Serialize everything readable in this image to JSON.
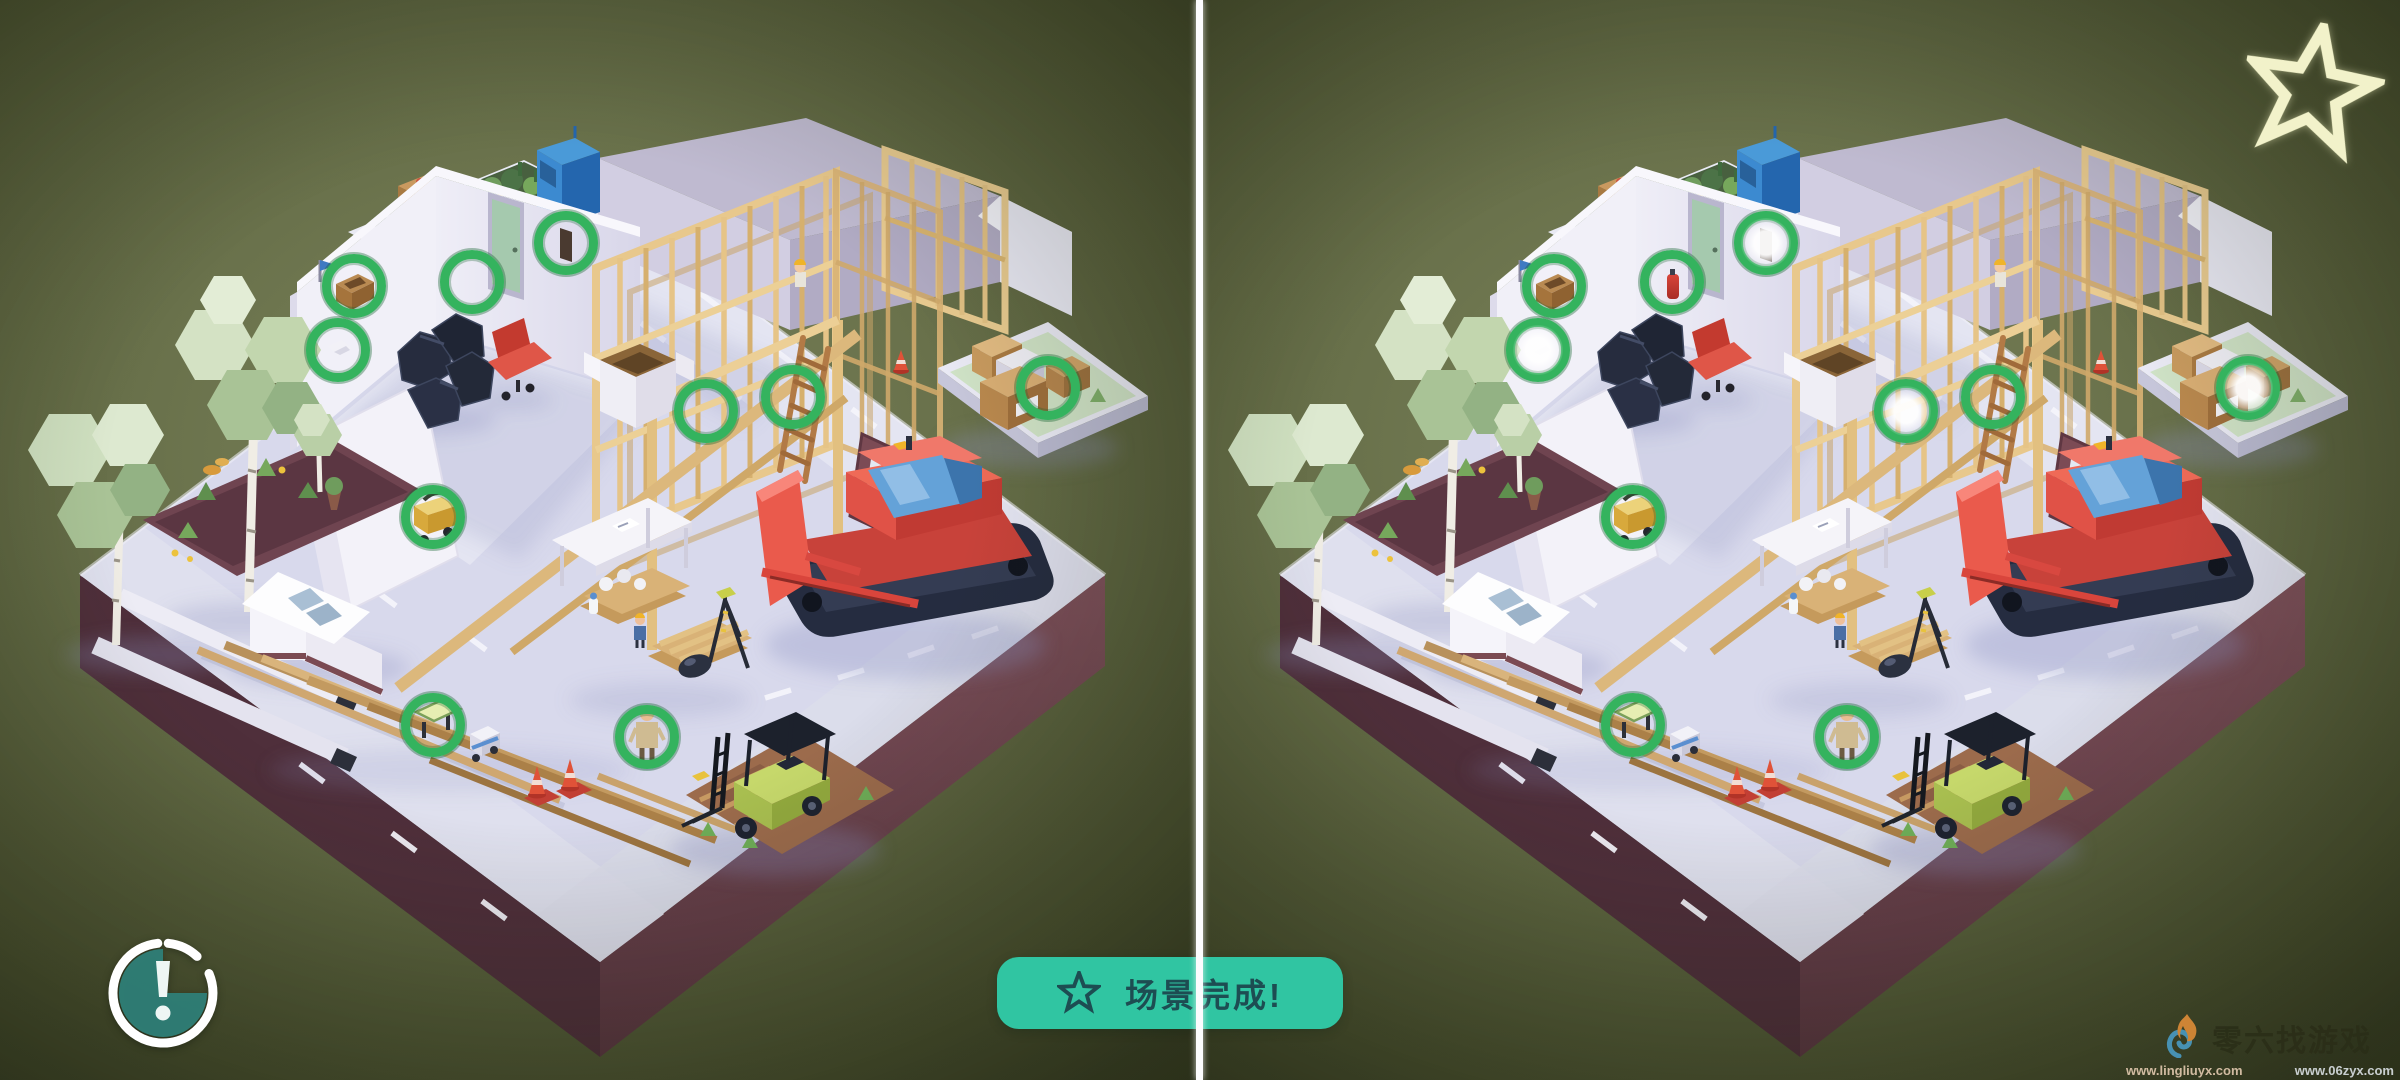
{
  "game": {
    "banner": {
      "icon": "star-outline",
      "text": "场景完成!",
      "bg_color": "#30c5a2",
      "text_color": "#1d4d52"
    },
    "hud": {
      "score_star_icon": "star-outline",
      "score_star_color": "#f2f2ca",
      "timer_icon": "timer-alert",
      "timer_fill_color": "#2f7f78",
      "timer_ring_color": "#ffffff"
    },
    "watermark": {
      "logo": "lingliu-flame-logo",
      "brand": "零六找游戏",
      "url_left": "www.lingliuyx.com",
      "url_right": "www.06zyx.com"
    },
    "colors": {
      "marker_green": "#34b35e",
      "background_olive": "#68704a",
      "platform_top": "#d8d9ec",
      "platform_side_dark": "#4f2f3b",
      "platform_side_light": "#74494f",
      "timber": "#e8c88c",
      "bulldozer_red": "#d9453c",
      "forklift_green": "#c6d86b",
      "divider_white": "#fcfcfe"
    },
    "panels": [
      {
        "id": "left",
        "scene": "construction-site"
      },
      {
        "id": "right",
        "scene": "construction-site"
      }
    ],
    "markers": [
      {
        "id": "wall-box",
        "x": 29.5,
        "y": 26.5,
        "glow_right": false
      },
      {
        "id": "wall-corner",
        "x": 39.3,
        "y": 26.1,
        "glow_right": false
      },
      {
        "id": "doorway",
        "x": 47.2,
        "y": 22.5,
        "glow_right": true
      },
      {
        "id": "wall-left",
        "x": 28.2,
        "y": 32.4,
        "glow_right": true
      },
      {
        "id": "beam-joint",
        "x": 58.8,
        "y": 38.1,
        "glow_right": true
      },
      {
        "id": "ladder",
        "x": 66.1,
        "y": 36.8,
        "glow_right": false
      },
      {
        "id": "boxes-stack",
        "x": 87.3,
        "y": 35.9,
        "glow_right": true
      },
      {
        "id": "toolbox",
        "x": 36.1,
        "y": 47.9,
        "glow_right": false
      },
      {
        "id": "green-box",
        "x": 36.1,
        "y": 67.1,
        "glow_right": false
      },
      {
        "id": "worker",
        "x": 53.9,
        "y": 68.2,
        "glow_right": false
      }
    ]
  }
}
